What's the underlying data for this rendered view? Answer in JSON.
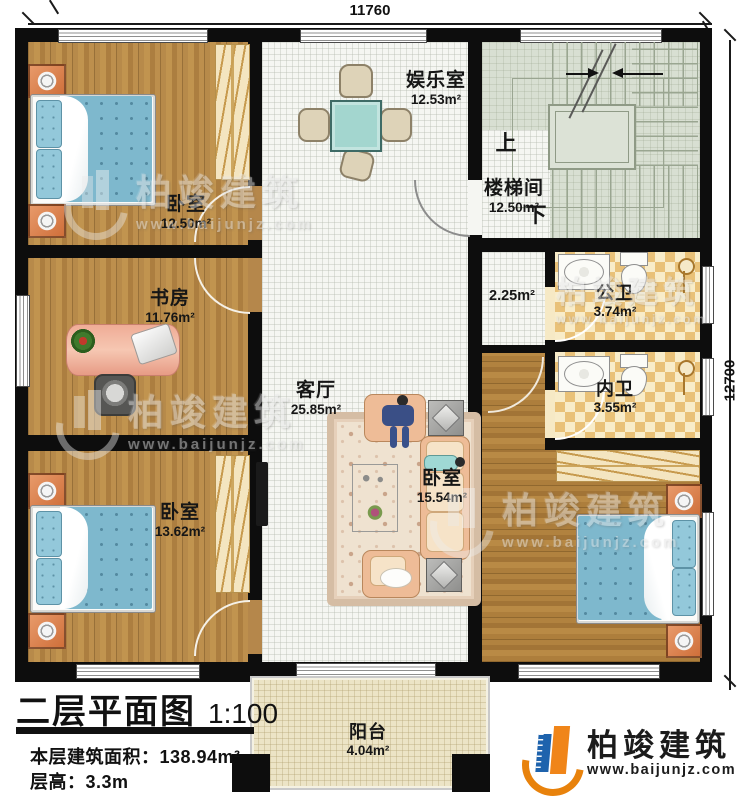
{
  "plan": {
    "title": "二层平面图",
    "scale": "1:100",
    "area_line": {
      "label": "本层建筑面积：",
      "value": "138.94m²"
    },
    "height_line": {
      "label": "层高：",
      "value": "3.3m"
    }
  },
  "dimensions": {
    "top": "11760",
    "right": "12700"
  },
  "rooms": {
    "bedroom_tl": {
      "name": "卧室",
      "area": "12.50m²"
    },
    "study": {
      "name": "书房",
      "area": "11.76m²"
    },
    "bedroom_bl": {
      "name": "卧室",
      "area": "13.62m²"
    },
    "entertainment": {
      "name": "娱乐室",
      "area": "12.53m²"
    },
    "living": {
      "name": "客厅",
      "area": "25.85m²"
    },
    "stairwell": {
      "name": "楼梯间",
      "area": "12.50m²",
      "up": "上",
      "down": "下"
    },
    "corridor": {
      "area": "2.25m²"
    },
    "public_bath": {
      "name": "公卫",
      "area": "3.74m²"
    },
    "private_bath": {
      "name": "内卫",
      "area": "3.55m²"
    },
    "bedroom_br": {
      "name": "卧室",
      "area": "15.54m²"
    },
    "balcony": {
      "name": "阳台",
      "area": "4.04m²"
    }
  },
  "branding": {
    "company": "柏竣建筑",
    "website": "www.baijunjz.com"
  },
  "watermark": {
    "company": "柏竣建筑",
    "website": "www.baijunjz.com"
  },
  "colors": {
    "wall": "#0d0d0d",
    "wood_floor": "#b5874b",
    "hall_floor": "#f5f6f2",
    "stair_floor": "#d8dfd2",
    "tile_dark": "#e9c178",
    "tile_light": "#f8ecc9",
    "balcony_floor": "#ece4c6",
    "bed_blue": "#7eb8cd",
    "brand_orange": "#e8820c",
    "brand_blue": "#1e63ad"
  }
}
